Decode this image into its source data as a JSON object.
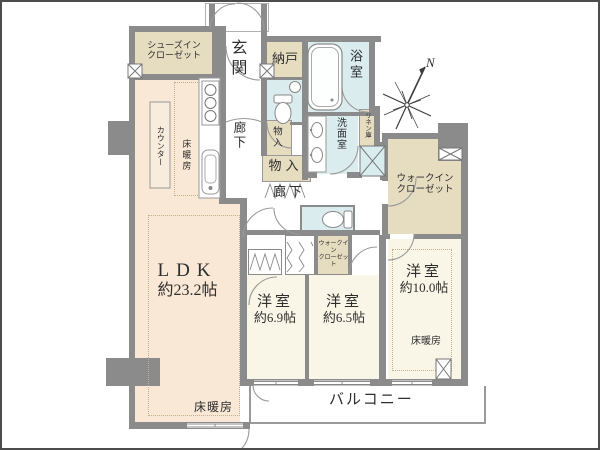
{
  "plan": {
    "type": "apartment-floor-plan",
    "compass_north": "N",
    "colors": {
      "wall": "#8b8b8b",
      "ldk_fill": "#fae8d6",
      "bedroom_fill": "#f9f6e8",
      "wet_fill": "#daecee",
      "closet_fill": "#e6dcc0",
      "balcony_line": "#9a9a9a",
      "heating_dot": "#c7ae8b",
      "text": "#2e2e2e"
    },
    "labels": {
      "genkan": "玄関",
      "shoes_closet": [
        "シューズイン",
        "クローゼット"
      ],
      "nando": "納戸",
      "bath": "浴室",
      "washroom": "洗面室",
      "linen": "リネン庫",
      "storage_small": "物入",
      "storage_large": "物入",
      "corridor_upper": "廊下",
      "corridor_lower": "廊下",
      "counter": "カウンター",
      "kitchen_heating": "床暖房",
      "ldk": {
        "name": "LDK",
        "size": "約23.2帖",
        "heating": "床暖房"
      },
      "bedroom_1": {
        "name": "洋室",
        "size": "約6.9帖"
      },
      "bedroom_2": {
        "name": "洋室",
        "size": "約6.5帖"
      },
      "bedroom_3": {
        "name": "洋室",
        "size": "約10.0帖",
        "heating": "床暖房"
      },
      "wic_small": [
        "ウォークイン",
        "クローゼット"
      ],
      "wic_large": [
        "ウォークイン",
        "クローゼット"
      ],
      "balcony": "バルコニー"
    }
  }
}
